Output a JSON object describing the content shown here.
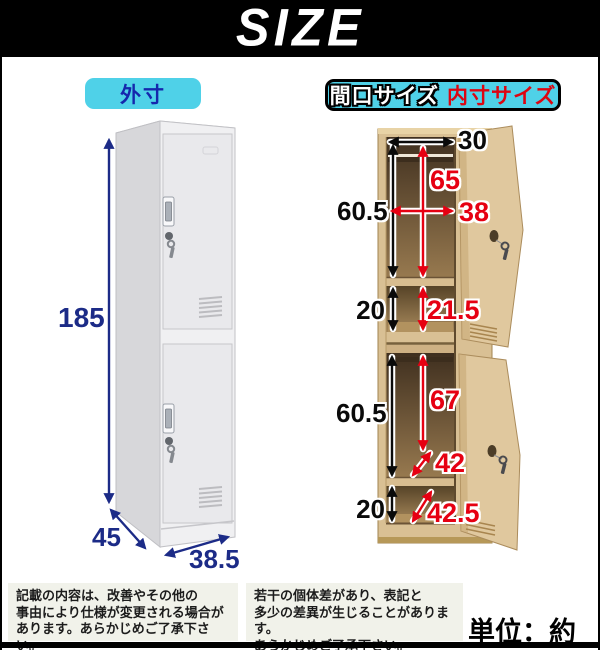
{
  "header": {
    "title": "SIZE"
  },
  "left_panel": {
    "label": "外寸",
    "height": "185",
    "depth": "45",
    "width": "38.5"
  },
  "right_panel": {
    "label_opening": "間口サイズ",
    "label_inner": "内寸サイズ",
    "top_width": "30",
    "upper_opening_height": "60.5",
    "upper_inner_height": "65",
    "inner_width": "38",
    "upper_shelf_height": "20",
    "upper_shelf_inner_height": "21.5",
    "lower_opening_height": "60.5",
    "lower_inner_height": "67",
    "lower_inner_depth": "42",
    "lower_shelf_height": "20",
    "lower_shelf_depth": "42.5"
  },
  "notes": {
    "left": [
      "記載の内容は、改善やその他の",
      "事由により仕様が変更される場合が",
      "あります。あらかじめご了承下さい。"
    ],
    "right": [
      "若干の個体差があり、表記と",
      "多少の差異が生じることがあります。",
      "あらかじめご了承下さい。"
    ],
    "unit": "単位：約cm"
  },
  "colors": {
    "accent_cyan": "#4fd1e8",
    "dim_navy": "#1c2b87",
    "dim_red": "#e60012",
    "locker_gray": "#f0f0f2",
    "locker_tan": "#d9c094"
  }
}
